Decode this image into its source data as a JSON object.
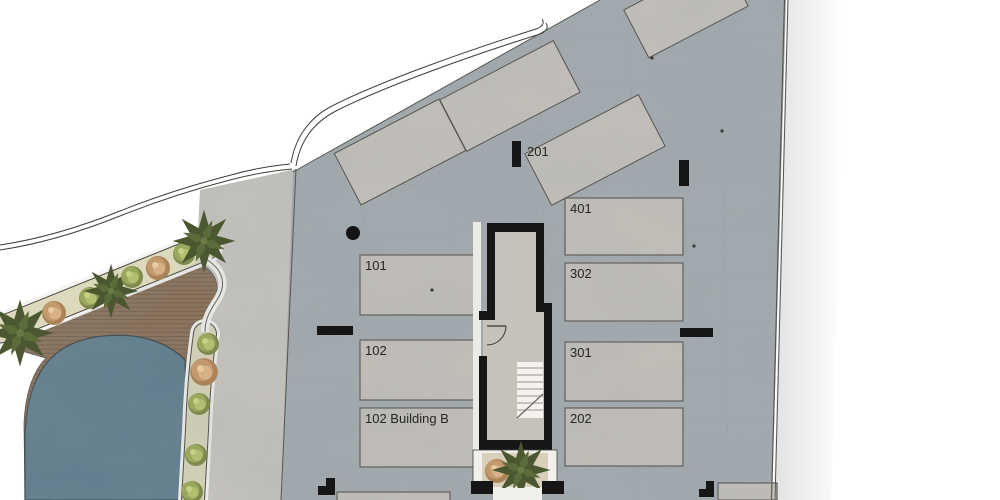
{
  "site_plan": {
    "marker_201": "201",
    "rooms_left": [
      {
        "label": "101"
      },
      {
        "label": "102"
      },
      {
        "label": "102 Building B"
      }
    ],
    "rooms_right": [
      {
        "label": "401"
      },
      {
        "label": "302"
      },
      {
        "label": "301"
      },
      {
        "label": "202"
      }
    ]
  },
  "colors": {
    "paper": "#ffffff",
    "concrete": "#a6adb2",
    "concrete_light": "#c8c4bd",
    "walkway": "#cbc8c2",
    "pool": "#5b7b8b",
    "deck": "#8a7158",
    "planting": "#dcd9bc",
    "bush_green": "#9aa75e",
    "bush_tan": "#c39a6e",
    "palm": "#4a5730",
    "wall": "#161616",
    "stair_floor": "#c6c2bb",
    "label_text": "#26251f"
  }
}
